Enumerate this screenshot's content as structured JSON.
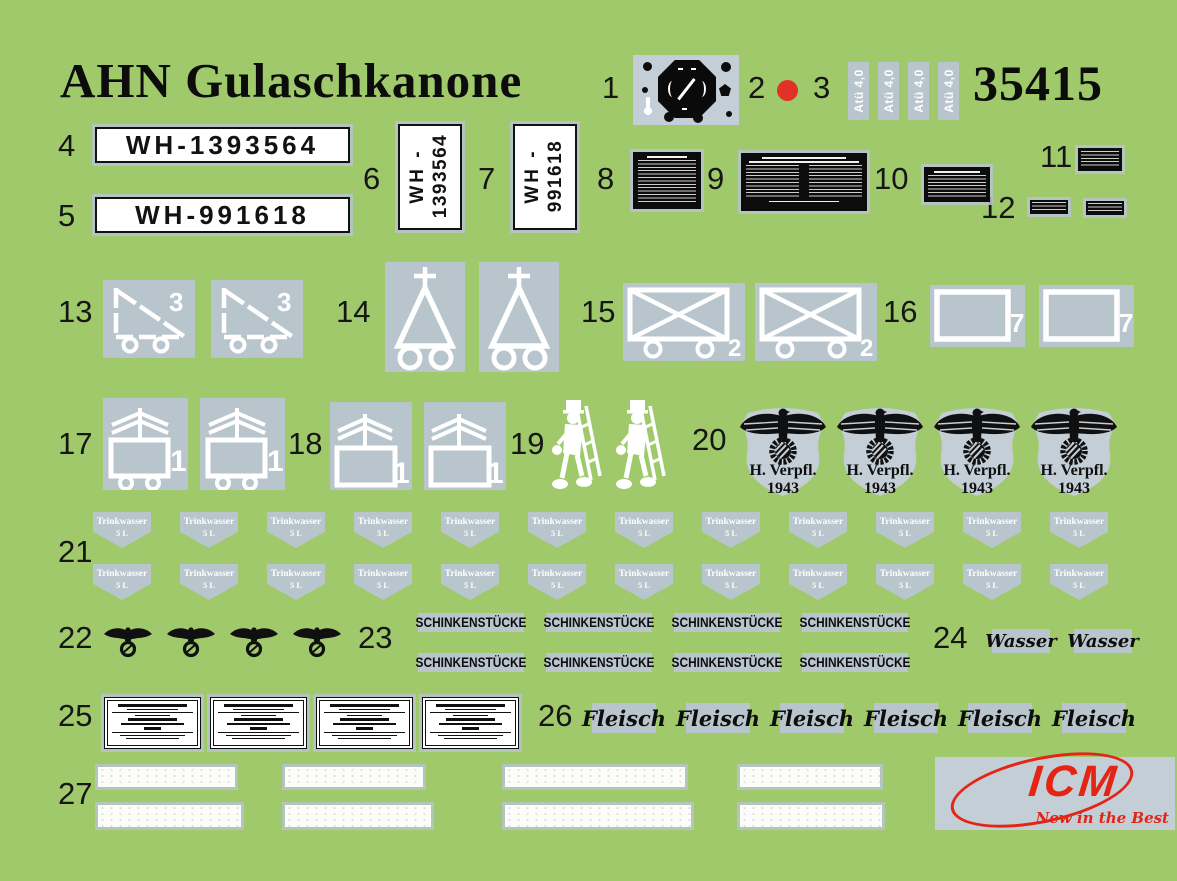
{
  "colors": {
    "bg": "#9fc96b",
    "gray": "#b9c5cd",
    "grayl": "#c3ced6",
    "red": "#e23128",
    "logo_red": "#e42415"
  },
  "header": {
    "title": "AHN Gulaschkanone",
    "kit_number": "35415"
  },
  "item_numbers": [
    "1",
    "2",
    "3",
    "4",
    "5",
    "6",
    "7",
    "8",
    "9",
    "10",
    "11",
    "12",
    "13",
    "14",
    "15",
    "16",
    "17",
    "18",
    "19",
    "20",
    "21",
    "22",
    "23",
    "24",
    "25",
    "26",
    "27"
  ],
  "decals": {
    "atu": {
      "count": 4,
      "text": "Atü 4,0"
    },
    "plate_h1": {
      "text": "WH-1393564"
    },
    "plate_h2": {
      "text": "WH-991618"
    },
    "plate_v1": {
      "prefix": "WH -",
      "number": "1393564"
    },
    "plate_v2": {
      "prefix": "WH -",
      "number": "991618"
    },
    "trailer": {
      "count": 2,
      "figure": "3"
    },
    "kitchen": {
      "count": 2
    },
    "crate": {
      "count": 2,
      "figure": "2"
    },
    "panel": {
      "count": 2,
      "figure": "7"
    },
    "cart": {
      "count": 2,
      "figure": "1"
    },
    "box": {
      "count": 2,
      "figure": "1"
    },
    "sweep": {
      "count": 2
    },
    "shield": {
      "count": 4,
      "line1": "H. Verpfl.",
      "line2": "1943"
    },
    "trinkwasser": {
      "rows": 2,
      "per_row": 12,
      "line1": "Trinkwasser",
      "line2": "5 L"
    },
    "eagle": {
      "count": 4
    },
    "schinken": {
      "rows": 2,
      "per_row": 4,
      "text": "SCHINKENSTÜCKE"
    },
    "wasser": {
      "count": 2,
      "text": "Wasser"
    },
    "card": {
      "count": 4
    },
    "fleisch": {
      "count": 6,
      "text": "Fleisch"
    },
    "strips": {
      "rows": 2,
      "per_row": 4
    }
  },
  "logo": {
    "name": "ICM",
    "slogan": "New in the Best"
  }
}
